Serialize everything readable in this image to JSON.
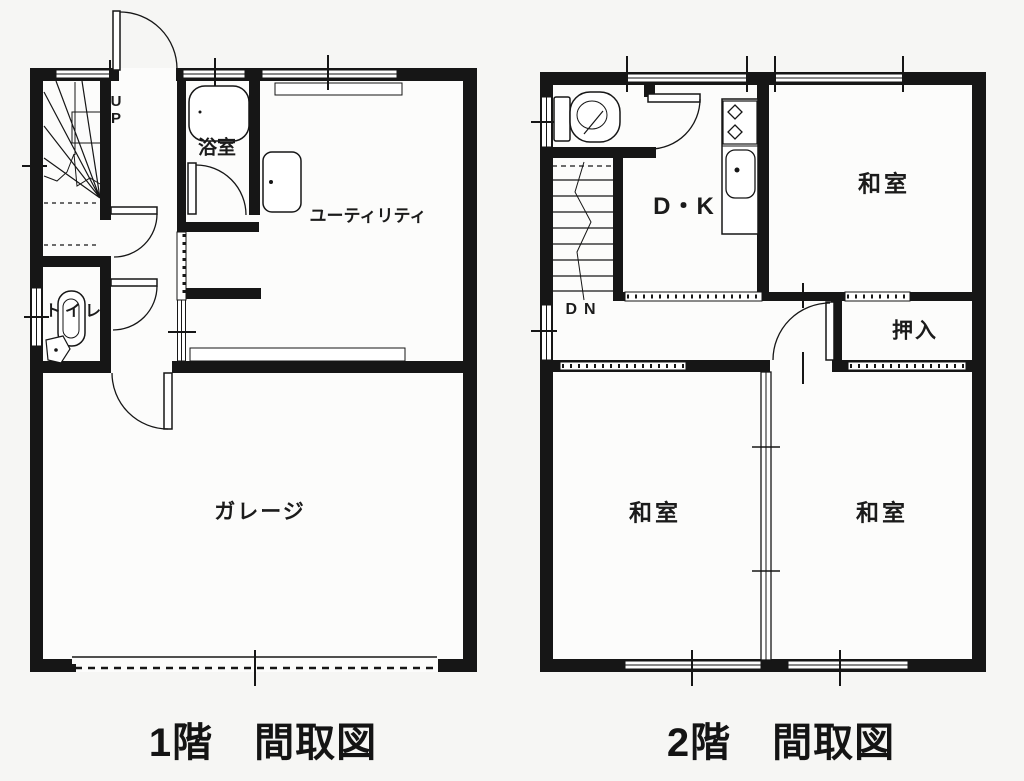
{
  "meta": {
    "document_type": "floor-plan-scan",
    "colors": {
      "ink": "#161616",
      "paper": "#f6f6f4",
      "room_fill": "#fcfcfb"
    }
  },
  "floor1": {
    "caption": "1階　間取図",
    "labels": {
      "stairs_up": "UP",
      "bath": "浴室",
      "utility": "ユーティリティ",
      "toilet": "トイレ",
      "garage": "ガレージ"
    }
  },
  "floor2": {
    "caption": "2階　間取図",
    "labels": {
      "stairs_down": "DN",
      "dk": "D・K",
      "washitsu_top": "和室",
      "oshiire": "押入",
      "washitsu_left": "和室",
      "washitsu_right": "和室"
    }
  }
}
